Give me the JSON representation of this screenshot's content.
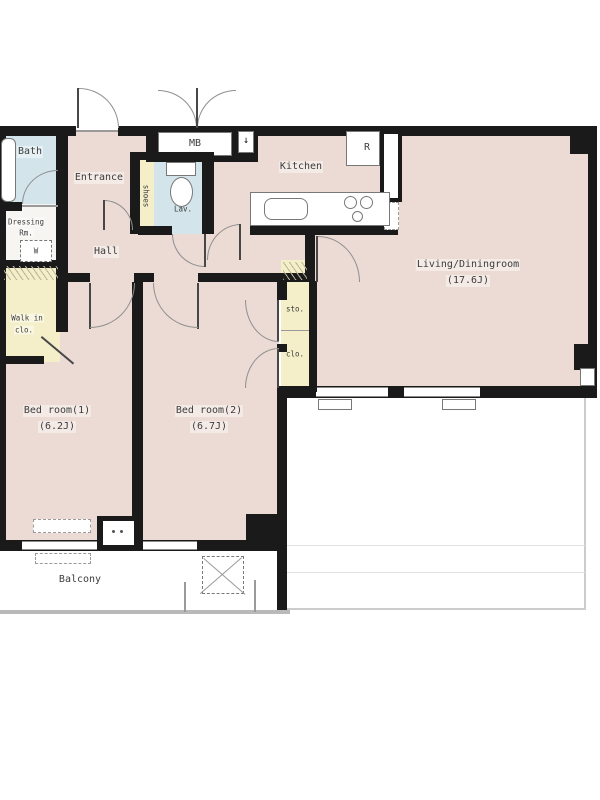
{
  "plan_title": "2LDK apartment floor plan",
  "colors": {
    "wall": "#1a1a1a",
    "room_pink": "#ecdad4",
    "wet_blue": "#d3e5eb",
    "closet_yellow": "#f4efc8"
  },
  "rooms": {
    "bath": {
      "label": "Bath"
    },
    "dressing": {
      "label": "Dressing",
      "label2": "Rm."
    },
    "washer": {
      "label": "W"
    },
    "walkin": {
      "label": "Walk in",
      "label2": "clo."
    },
    "entrance": {
      "label": "Entrance"
    },
    "hall": {
      "label": "Hall"
    },
    "shoes": {
      "label": "shoes"
    },
    "lav": {
      "label": "Lav."
    },
    "mb": {
      "label": "MB"
    },
    "kitchen": {
      "label": "Kitchen"
    },
    "fridge": {
      "label": "R"
    },
    "living": {
      "label": "Living/Diningroom",
      "area": "(17.6J)"
    },
    "bed1": {
      "label": "Bed room(1)",
      "area": "(6.2J)"
    },
    "bed2": {
      "label": "Bed room(2)",
      "area": "(6.7J)"
    },
    "sto": {
      "label": "sto."
    },
    "clo": {
      "label": "clo."
    },
    "balcony": {
      "label": "Balcony"
    }
  },
  "symbols": {
    "entry_arrow": "↓"
  }
}
